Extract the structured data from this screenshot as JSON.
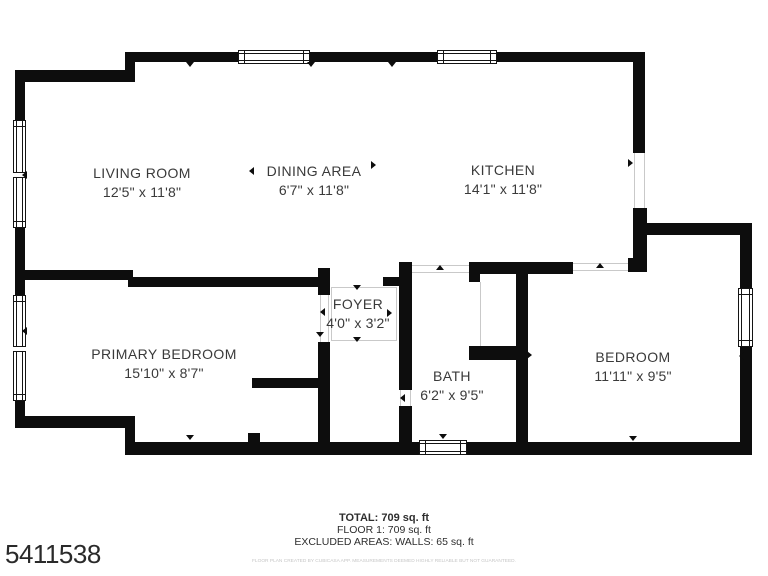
{
  "plan_id": "5411538",
  "footer": {
    "total": "TOTAL: 709 sq. ft",
    "floor": "FLOOR 1: 709 sq. ft",
    "excluded": "EXCLUDED AREAS: WALLS: 65 sq. ft",
    "disclaimer": "FLOOR PLAN CREATED BY CUBICASA APP. MEASUREMENTS DEEMED HIGHLY RELIABLE BUT NOT GUARANTEED."
  },
  "colors": {
    "wall": "#0d0d0d",
    "label_text": "#3a3a3a",
    "guide_line": "#c9c9c9",
    "disclaimer_text": "#c6c6c6",
    "background": "#ffffff"
  },
  "rooms": [
    {
      "id": "living-room",
      "name": "LIVING ROOM",
      "dims": "12'5\" x 11'8\"",
      "cx": 142,
      "cy": 183
    },
    {
      "id": "dining-area",
      "name": "DINING AREA",
      "dims": "6'7\" x 11'8\"",
      "cx": 314,
      "cy": 181
    },
    {
      "id": "kitchen",
      "name": "KITCHEN",
      "dims": "14'1\" x 11'8\"",
      "cx": 503,
      "cy": 180
    },
    {
      "id": "foyer",
      "name": "FOYER",
      "dims": "4'0\" x 3'2\"",
      "cx": 358,
      "cy": 314
    },
    {
      "id": "primary-bedroom",
      "name": "PRIMARY BEDROOM",
      "dims": "15'10\" x 8'7\"",
      "cx": 164,
      "cy": 364
    },
    {
      "id": "bath",
      "name": "BATH",
      "dims": "6'2\" x 9'5\"",
      "cx": 452,
      "cy": 386
    },
    {
      "id": "bedroom",
      "name": "BEDROOM",
      "dims": "11'11\" x 9'5\"",
      "cx": 633,
      "cy": 367
    }
  ],
  "walls": [
    {
      "x": 15,
      "y": 70,
      "w": 10,
      "h": 50
    },
    {
      "x": 15,
      "y": 228,
      "w": 10,
      "h": 67
    },
    {
      "x": 15,
      "y": 401,
      "w": 10,
      "h": 27
    },
    {
      "x": 15,
      "y": 70,
      "w": 118,
      "h": 12
    },
    {
      "x": 125,
      "y": 52,
      "w": 10,
      "h": 30
    },
    {
      "x": 125,
      "y": 52,
      "w": 520,
      "h": 10
    },
    {
      "x": 633,
      "y": 52,
      "w": 12,
      "h": 101
    },
    {
      "x": 633,
      "y": 208,
      "w": 14,
      "h": 60
    },
    {
      "x": 640,
      "y": 223,
      "w": 112,
      "h": 12
    },
    {
      "x": 740,
      "y": 223,
      "w": 12,
      "h": 65
    },
    {
      "x": 740,
      "y": 347,
      "w": 12,
      "h": 108
    },
    {
      "x": 133,
      "y": 442,
      "w": 619,
      "h": 13
    },
    {
      "x": 25,
      "y": 416,
      "w": 110,
      "h": 12
    },
    {
      "x": 125,
      "y": 416,
      "w": 10,
      "h": 39
    },
    {
      "x": 25,
      "y": 270,
      "w": 108,
      "h": 10
    },
    {
      "x": 128,
      "y": 277,
      "w": 192,
      "h": 10
    },
    {
      "x": 318,
      "y": 268,
      "w": 12,
      "h": 27
    },
    {
      "x": 383,
      "y": 277,
      "w": 17,
      "h": 9
    },
    {
      "x": 399,
      "y": 262,
      "w": 13,
      "h": 128
    },
    {
      "x": 399,
      "y": 406,
      "w": 13,
      "h": 49
    },
    {
      "x": 469,
      "y": 262,
      "w": 104,
      "h": 12
    },
    {
      "x": 469,
      "y": 262,
      "w": 11,
      "h": 20
    },
    {
      "x": 628,
      "y": 258,
      "w": 19,
      "h": 14
    },
    {
      "x": 516,
      "y": 262,
      "w": 12,
      "h": 193
    },
    {
      "x": 469,
      "y": 346,
      "w": 59,
      "h": 14
    },
    {
      "x": 252,
      "y": 378,
      "w": 78,
      "h": 10
    },
    {
      "x": 318,
      "y": 342,
      "w": 12,
      "h": 113
    },
    {
      "x": 248,
      "y": 433,
      "w": 12,
      "h": 11
    }
  ],
  "windows": [
    {
      "x": 13,
      "y": 120,
      "w": 13,
      "h": 108,
      "orient": "v",
      "divider": true
    },
    {
      "x": 13,
      "y": 295,
      "w": 13,
      "h": 106,
      "orient": "v",
      "divider": true
    },
    {
      "x": 238,
      "y": 50,
      "w": 72,
      "h": 14,
      "orient": "h",
      "divider": false
    },
    {
      "x": 437,
      "y": 50,
      "w": 60,
      "h": 14,
      "orient": "h",
      "divider": false
    },
    {
      "x": 419,
      "y": 440,
      "w": 48,
      "h": 15,
      "orient": "h",
      "divider": false
    },
    {
      "x": 738,
      "y": 288,
      "w": 15,
      "h": 59,
      "orient": "v",
      "divider": false
    }
  ],
  "guides": [
    {
      "x": 634,
      "y": 153,
      "w": 1,
      "h": 55
    },
    {
      "x": 644,
      "y": 153,
      "w": 1,
      "h": 55
    },
    {
      "x": 573,
      "y": 263,
      "w": 55,
      "h": 1
    },
    {
      "x": 573,
      "y": 270,
      "w": 55,
      "h": 1
    },
    {
      "x": 412,
      "y": 265,
      "w": 57,
      "h": 1
    },
    {
      "x": 412,
      "y": 272,
      "w": 57,
      "h": 1
    },
    {
      "x": 480,
      "y": 282,
      "w": 1,
      "h": 64
    },
    {
      "x": 331,
      "y": 287,
      "w": 66,
      "h": 1
    },
    {
      "x": 331,
      "y": 340,
      "w": 66,
      "h": 1
    },
    {
      "x": 331,
      "y": 287,
      "w": 1,
      "h": 54
    },
    {
      "x": 396,
      "y": 287,
      "w": 1,
      "h": 54
    },
    {
      "x": 320,
      "y": 295,
      "w": 1,
      "h": 47
    },
    {
      "x": 328,
      "y": 295,
      "w": 1,
      "h": 47
    },
    {
      "x": 400,
      "y": 390,
      "w": 1,
      "h": 16
    },
    {
      "x": 410,
      "y": 390,
      "w": 1,
      "h": 16
    }
  ],
  "marks": [
    {
      "x": 190,
      "y": 66,
      "dir": "down"
    },
    {
      "x": 311,
      "y": 66,
      "dir": "down"
    },
    {
      "x": 392,
      "y": 66,
      "dir": "down"
    },
    {
      "x": 253,
      "y": 171,
      "dir": "left"
    },
    {
      "x": 375,
      "y": 165,
      "dir": "right"
    },
    {
      "x": 632,
      "y": 163,
      "dir": "right"
    },
    {
      "x": 26,
      "y": 175,
      "dir": "left"
    },
    {
      "x": 26,
      "y": 331,
      "dir": "left"
    },
    {
      "x": 357,
      "y": 289,
      "dir": "down"
    },
    {
      "x": 324,
      "y": 312,
      "dir": "left"
    },
    {
      "x": 320,
      "y": 336,
      "dir": "down"
    },
    {
      "x": 391,
      "y": 313,
      "dir": "right"
    },
    {
      "x": 357,
      "y": 341,
      "dir": "down"
    },
    {
      "x": 404,
      "y": 398,
      "dir": "left"
    },
    {
      "x": 443,
      "y": 438,
      "dir": "down"
    },
    {
      "x": 190,
      "y": 439,
      "dir": "down"
    },
    {
      "x": 633,
      "y": 440,
      "dir": "down"
    },
    {
      "x": 600,
      "y": 267,
      "dir": "up"
    },
    {
      "x": 743,
      "y": 356,
      "dir": "left"
    },
    {
      "x": 440,
      "y": 269,
      "dir": "up"
    },
    {
      "x": 531,
      "y": 355,
      "dir": "right"
    }
  ]
}
